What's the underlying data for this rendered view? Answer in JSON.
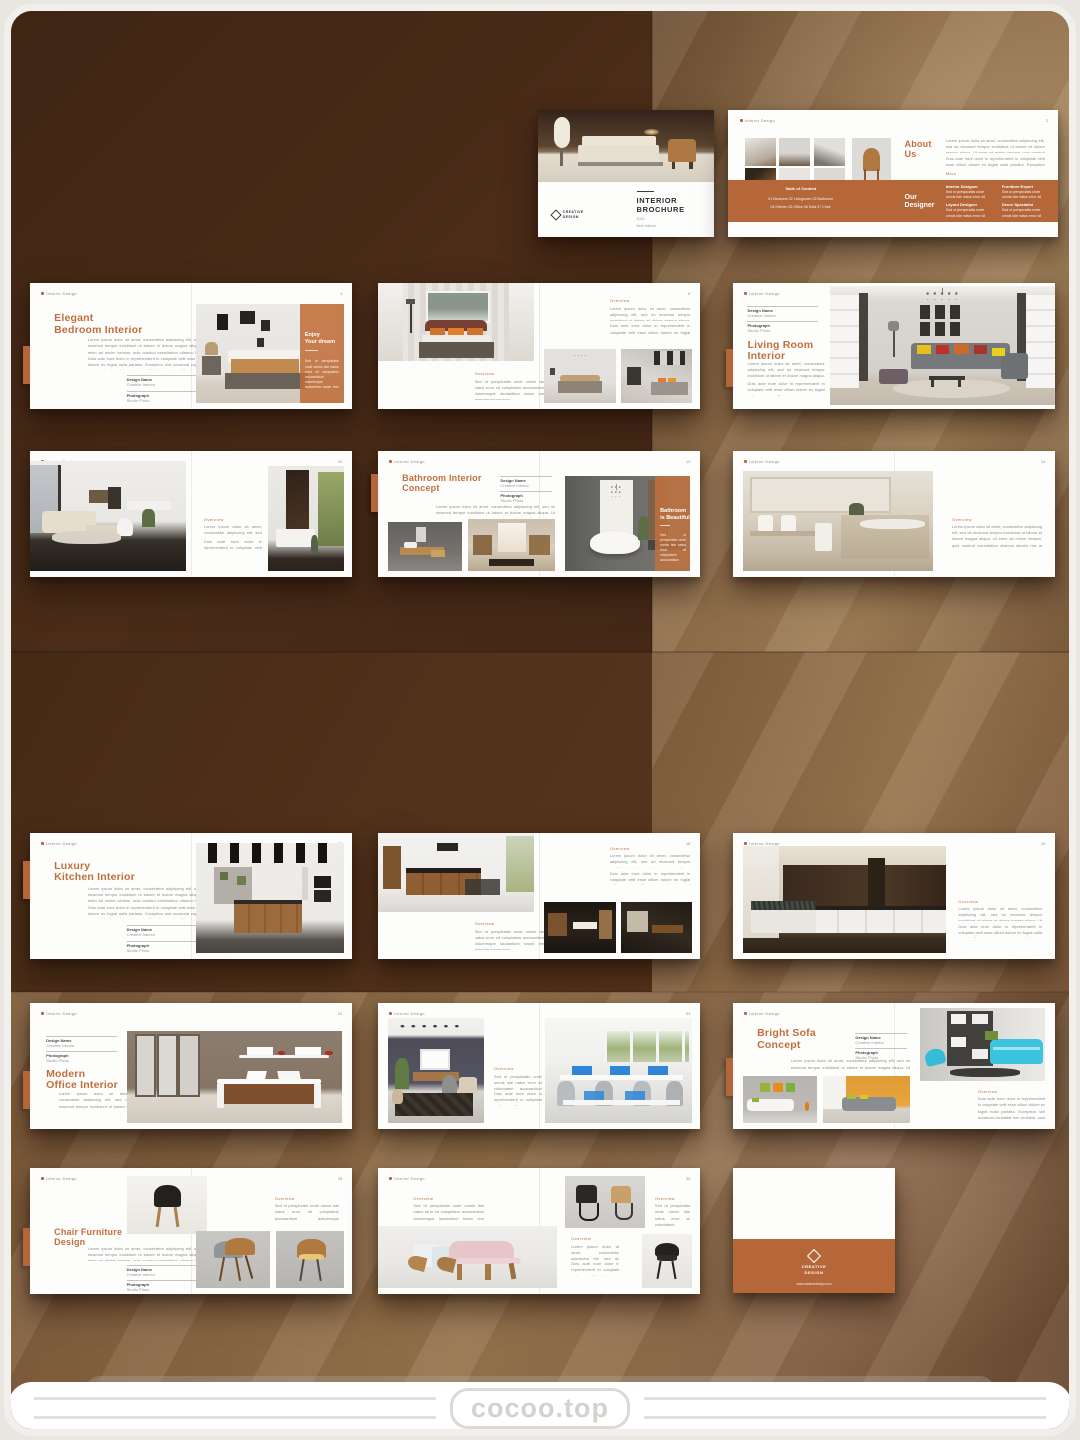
{
  "watermark": {
    "text": "cocoo.top"
  },
  "brand": {
    "line1": "CREATIVE",
    "line2": "DESIGN"
  },
  "common": {
    "header": "Interior Design",
    "label_design": "Design Name",
    "label_photo": "Photograph",
    "val_design": "Creative Interior",
    "val_photo": "Studio Photo",
    "mini_label": "Overview",
    "body_a": "Lorem ipsum dolor sit amet, consectetur adipiscing elit, sed do eiusmod tempor incididunt ut labore et dolore magna aliqua. Ut enim ad minim veniam, quis nostrud exercitation ullamco laboris nisi ut aliquip ex ea commodo consequat duis aute irure dolor in reprehenderit.",
    "body_b": "Duis aute irure dolor in reprehenderit in voluptate velit esse cillum dolore eu fugiat nulla pariatur. Excepteur sint occaecat cupidatat non proident, sunt in culpa qui officia deserunt mollit anim id est laborum sed ut perspiciatis.",
    "body_s": "Sed ut perspiciatis unde omnis iste natus error sit voluptatem accusantium doloremque laudantium totam rem aperiam eaque ipsa."
  },
  "cover": {
    "title1": "INTERIOR",
    "title2": "BROCHURE",
    "year": "2022",
    "tagline": "Best Interior"
  },
  "about": {
    "pg": "2",
    "t1": "About",
    "t2": "Us",
    "more": "More",
    "band1": "Our",
    "band2": "Designer",
    "toc_title": "Table of Content",
    "toc1": "01 Bedroom    02 Livingroom    03 Bathroom",
    "toc2": "04 Kitchen    05 Office    06 Sofa    07 Chair",
    "d1": "Interior Designer",
    "d2": "Layout Designer",
    "d3": "Furniture Expert",
    "d4": "Decor Specialist"
  },
  "bedroom1": {
    "pg": "4",
    "t1": "Elegant",
    "t2": "Bedroom Interior",
    "ov1": "Enjoy",
    "ov2": "Your dream"
  },
  "bedroom2": {
    "pg": "6"
  },
  "living1": {
    "pg": "8",
    "t1": "Living Room",
    "t2": "Interior"
  },
  "living2": {
    "pg": "10"
  },
  "bathroom1": {
    "pg": "12",
    "t1": "Bathroom Interior",
    "t2": "Concept",
    "ov1": "Bathroom",
    "ov2": "is Beautiful"
  },
  "bathroom2": {
    "pg": "14"
  },
  "kitchen1": {
    "pg": "16",
    "t1": "Luxury",
    "t2": "Kitchen Interior"
  },
  "kitchen2": {
    "pg": "18"
  },
  "kitchen3": {
    "pg": "20"
  },
  "office1": {
    "pg": "22",
    "t1": "Modern",
    "t2": "Office Interior"
  },
  "office2": {
    "pg": "24"
  },
  "sofa1": {
    "pg": "26",
    "t1": "Bright Sofa",
    "t2": "Concept"
  },
  "chair1": {
    "pg": "28",
    "t1": "Chair Furniture",
    "t2": "Design"
  },
  "chair2": {
    "pg": "30"
  },
  "backcover": {
    "url": "www.creativedesign.com"
  }
}
